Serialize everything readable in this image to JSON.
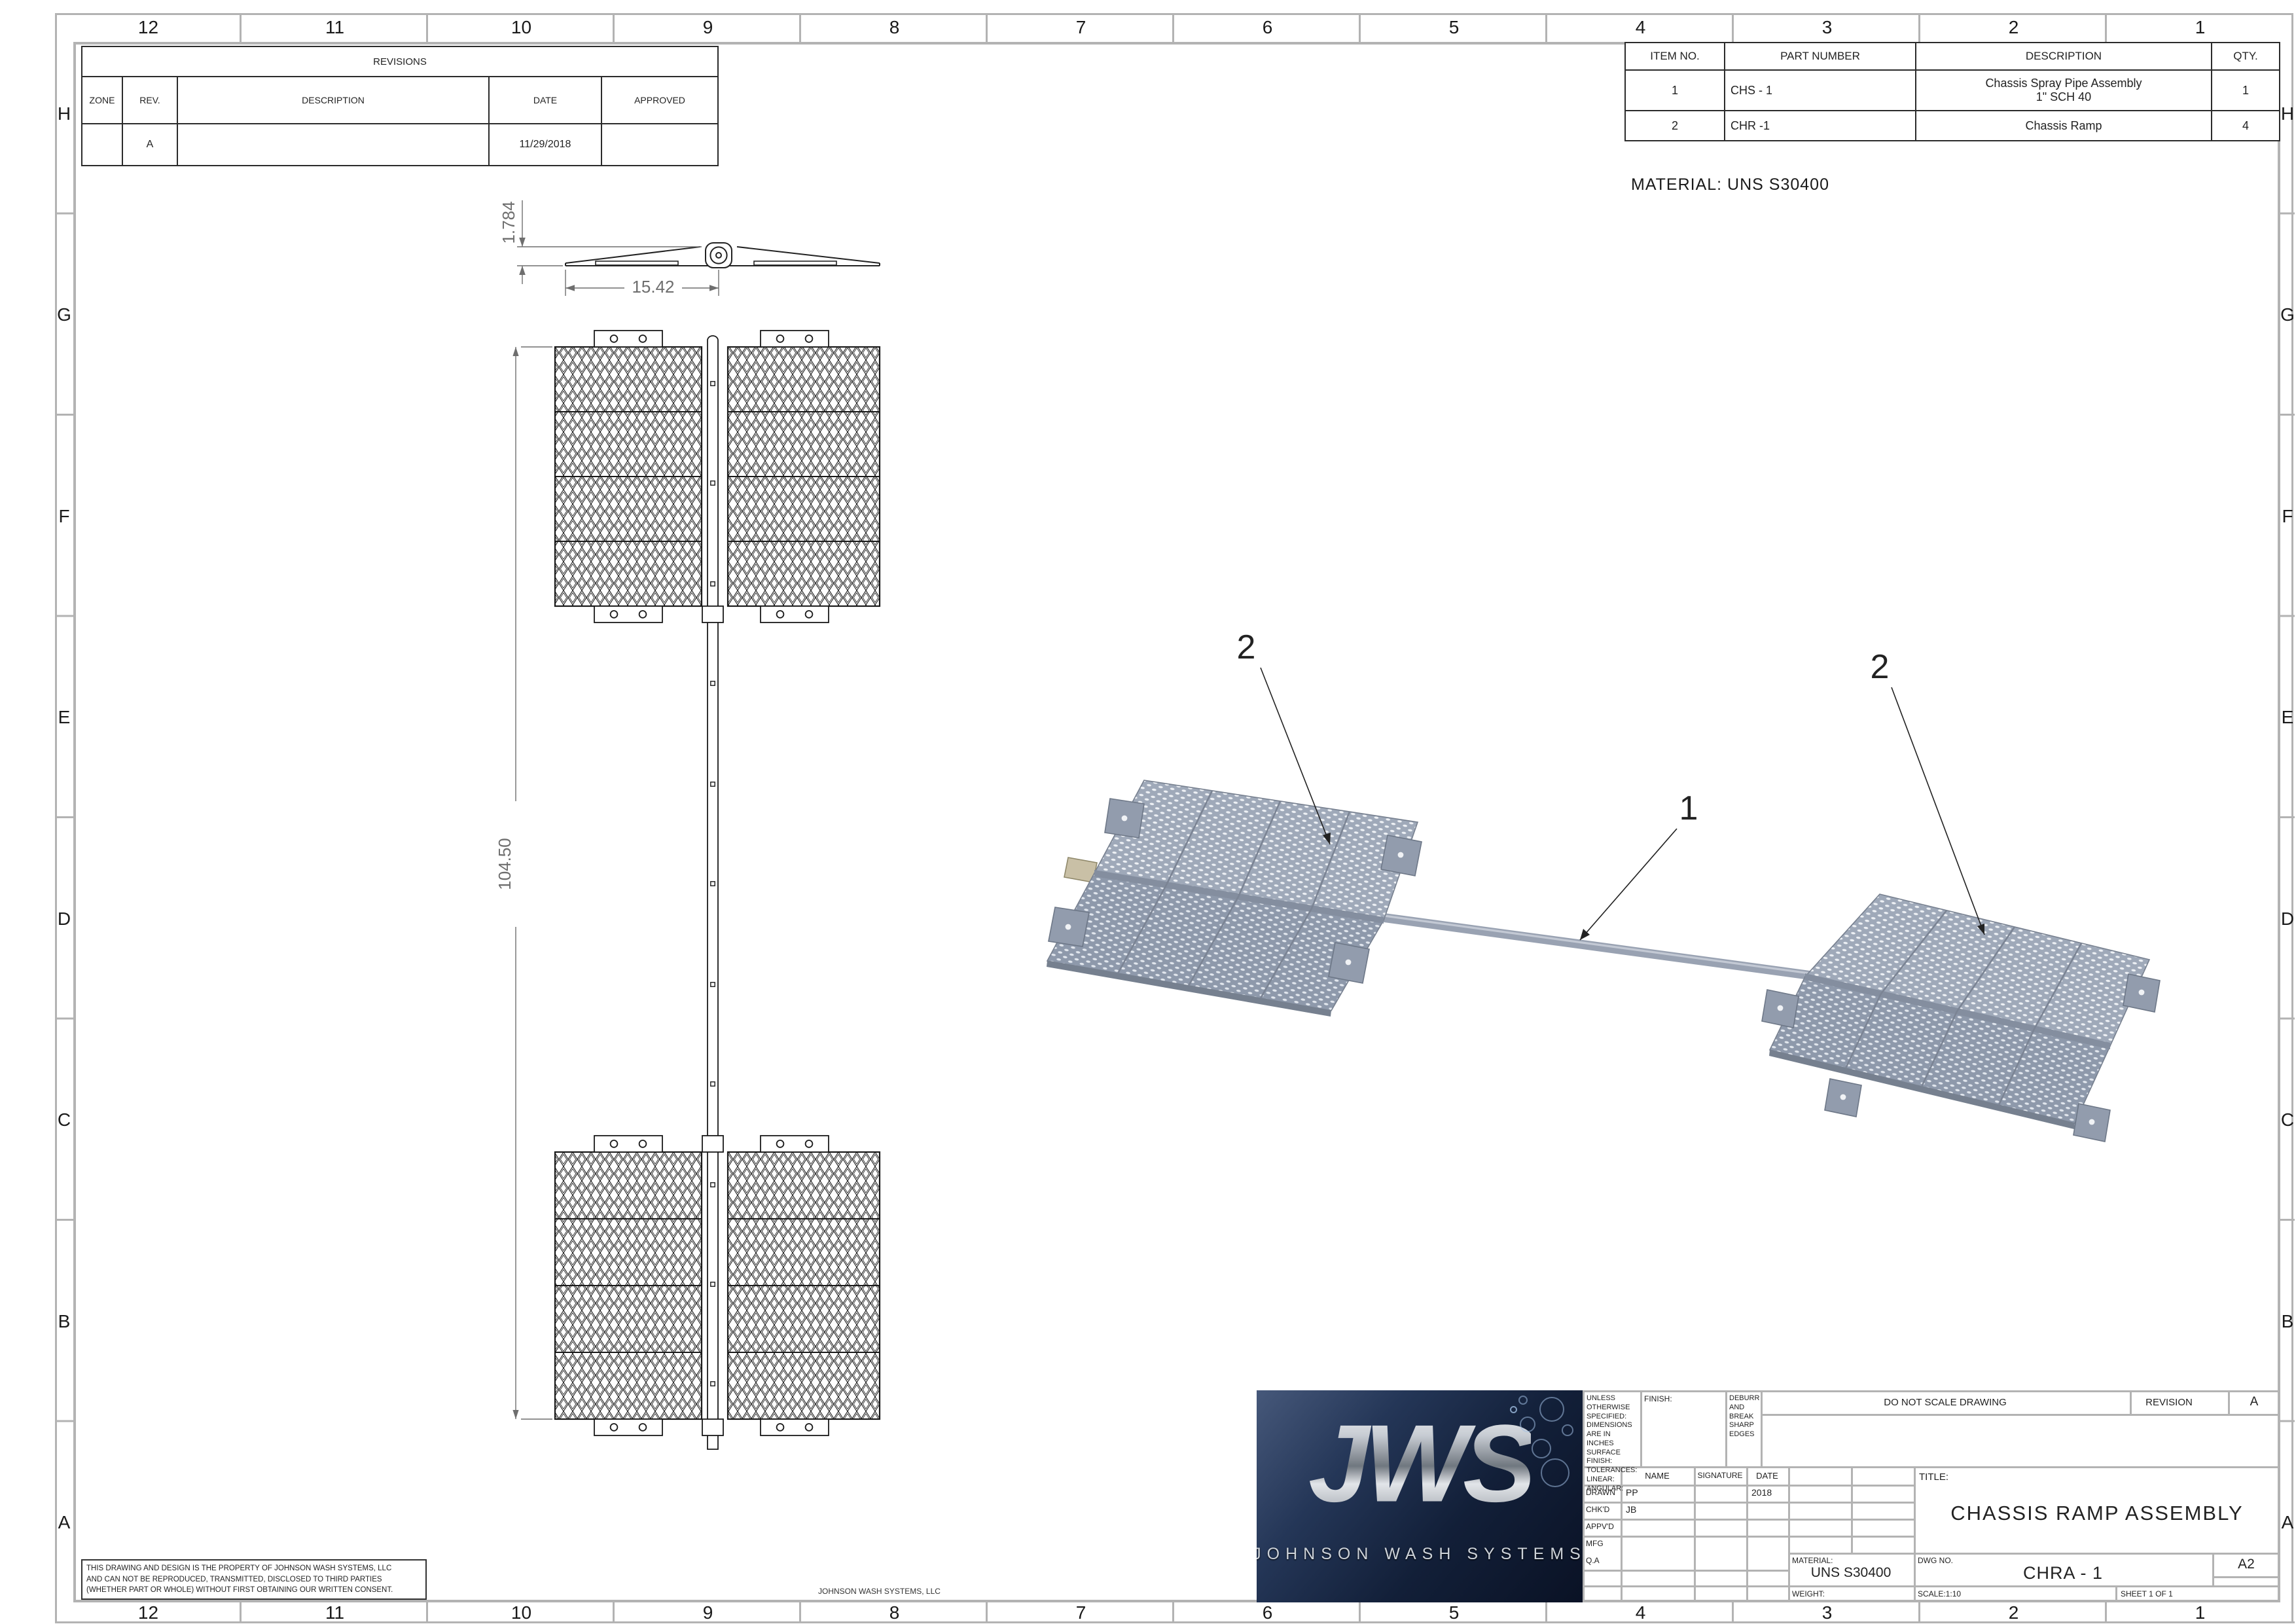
{
  "zones": {
    "top": [
      "12",
      "11",
      "10",
      "9",
      "8",
      "7",
      "6",
      "5",
      "4",
      "3",
      "2",
      "1"
    ],
    "bottom": [
      "12",
      "11",
      "10",
      "9",
      "8",
      "7",
      "6",
      "5",
      "4",
      "3",
      "2",
      "1"
    ],
    "left": [
      "H",
      "G",
      "F",
      "E",
      "D",
      "C",
      "B",
      "A"
    ],
    "right": [
      "H",
      "G",
      "F",
      "E",
      "D",
      "C",
      "B",
      "A"
    ]
  },
  "revisions": {
    "title": "REVISIONS",
    "headers": [
      "ZONE",
      "REV.",
      "DESCRIPTION",
      "DATE",
      "APPROVED"
    ],
    "row": {
      "zone": "",
      "rev": "A",
      "description": "",
      "date": "11/29/2018",
      "approved": ""
    }
  },
  "parts_table": {
    "headers": [
      "ITEM NO.",
      "PART NUMBER",
      "DESCRIPTION",
      "QTY."
    ],
    "rows": [
      [
        "1",
        "CHS - 1",
        "Chassis Spray Pipe Assembly\n1\" SCH 40",
        "1"
      ],
      [
        "2",
        "CHR -1",
        "Chassis Ramp",
        "4"
      ]
    ]
  },
  "notes": {
    "material": "MATERIAL:  UNS S30400"
  },
  "dims": {
    "height": "1.784",
    "half_width": "15.42",
    "length": "104.50"
  },
  "balloons": {
    "left": "2",
    "pipe": "1",
    "right": "2"
  },
  "title_block": {
    "uos": "UNLESS OTHERWISE SPECIFIED:\nDIMENSIONS ARE IN INCHES\nSURFACE FINISH:\nTOLERANCES:\n LINEAR:\n ANGULAR:",
    "finish_label": "FINISH:",
    "deburr": "DEBURR AND\nBREAK SHARP\nEDGES",
    "do_not_scale": "DO NOT SCALE DRAWING",
    "revision_label": "REVISION",
    "revision": "A",
    "name_header": "NAME",
    "signature_header": "SIGNATURE",
    "date_header": "DATE",
    "rows": {
      "drawn_label": "DRAWN",
      "drawn_name": "PP",
      "drawn_date": "2018",
      "chkd_label": "CHK'D",
      "chkd_name": "JB",
      "appvd_label": "APPV'D",
      "mfg_label": "MFG",
      "qa_label": "Q.A"
    },
    "title_label": "TITLE:",
    "title": "CHASSIS RAMP ASSEMBLY",
    "material_label": "MATERIAL:",
    "material": "UNS S30400",
    "weight_label": "WEIGHT:",
    "dwg_label": "DWG NO.",
    "dwg_no": "CHRA - 1",
    "size": "A2",
    "scale": "SCALE:1:10",
    "sheet": "SHEET 1 OF 1",
    "logo": {
      "acronym": "JWS",
      "name": "JOHNSON WASH SYSTEMS"
    }
  },
  "footer": {
    "line1": "THIS DRAWING AND DESIGN IS THE PROPERTY OF JOHNSON WASH SYSTEMS, LLC",
    "line2": "AND CAN NOT BE REPRODUCED, TRANSMITTED, DISCLOSED TO THIRD PARTIES",
    "line3": "(WHETHER PART OR WHOLE) WITHOUT FIRST OBTAINING OUR WRITTEN CONSENT.",
    "company": "JOHNSON WASH SYSTEMS, LLC"
  },
  "colors": {
    "border_gray": "#b3b3b3",
    "line_black": "#1a1a1a",
    "dim_gray": "#6e6e6e",
    "metal_light": "#9fa9b9",
    "metal_dark": "#8e99ab",
    "logo_navy": "#16233c"
  }
}
